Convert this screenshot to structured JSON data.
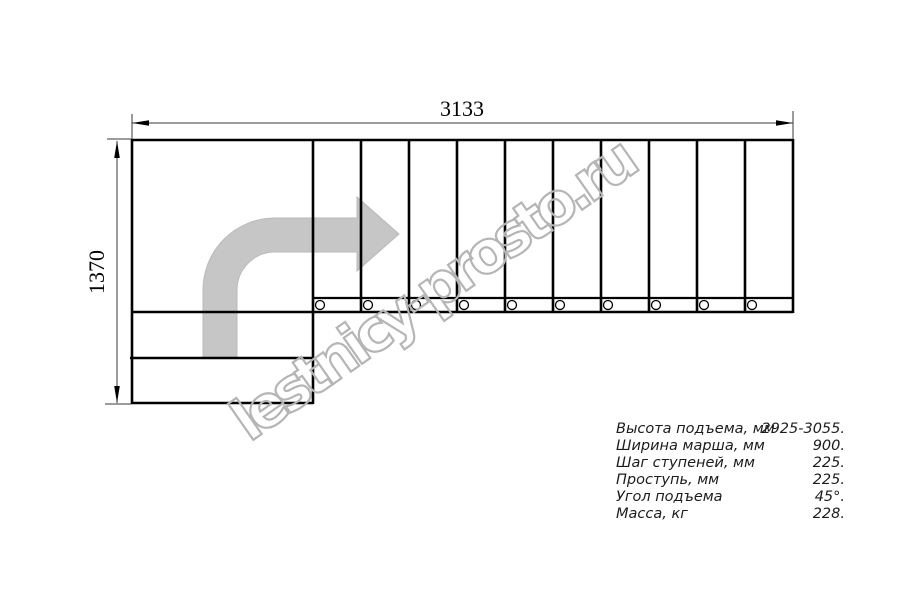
{
  "diagram": {
    "type": "staircase-plan-technical-drawing",
    "width_label": "3133",
    "height_label": "1370",
    "watermark": "lestnicy-prosto.ru",
    "steps": {
      "straight_flight_treads": 10,
      "lower_entry_treads": 2,
      "landing": 1,
      "baluster_circles": 10
    },
    "colors": {
      "line": "#000000",
      "arrow_fill": "#c6c6c6",
      "watermark": "#b5b5b5",
      "spec_text": "#1c1c1c",
      "background": "#ffffff"
    }
  },
  "specs": {
    "rows": [
      {
        "label": "Высота подъема, мм",
        "value": "2925-3055."
      },
      {
        "label": "Ширина марша, мм",
        "value": "900."
      },
      {
        "label": "Шаг ступеней, мм",
        "value": "225."
      },
      {
        "label": "Проступь, мм",
        "value": "225."
      },
      {
        "label": "Угол подъема",
        "value": "45°."
      },
      {
        "label": "Масса, кг",
        "value": "228."
      }
    ]
  }
}
